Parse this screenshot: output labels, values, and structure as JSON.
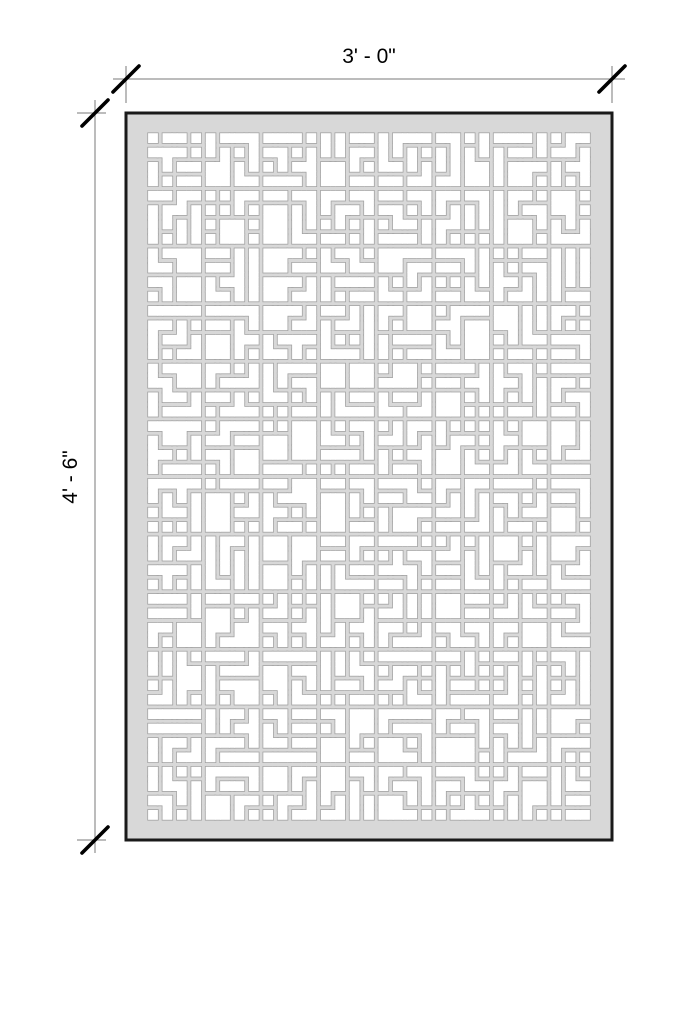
{
  "drawing": {
    "title": "decorative panel shop drawing",
    "width_label": "3' - 0\"",
    "height_label": "4' - 6\""
  },
  "panel": {
    "x": 126,
    "y": 113,
    "width": 486,
    "height": 727,
    "fill": "#d8d8d8",
    "border_color": "#1a1a1a",
    "border_width": 3
  },
  "pattern": {
    "seed": 12,
    "cols": 31,
    "rows": 48,
    "pitch": 14.4,
    "gap": 4.6,
    "block": 4,
    "cutout_fill": "#ffffff",
    "outline_color": "#a3a3a3",
    "outline_width": 1.6,
    "group_sizes": [
      1,
      1,
      2,
      2,
      2,
      3,
      3,
      3,
      3,
      4,
      4,
      4,
      4,
      5,
      5,
      6
    ]
  },
  "dimensions": {
    "line_color": "#7a7a7a",
    "line_width": 1,
    "tick_color": "#000000",
    "tick_width": 3.6,
    "tick_half": 13,
    "top": {
      "label": "3' - 0\"",
      "y": 79,
      "x1": 126,
      "x2": 612,
      "overshoot": 13,
      "ext_a": 66,
      "ext_b": 103
    },
    "left": {
      "label": "4' - 6\"",
      "x": 95,
      "y1": 113,
      "y2": 840,
      "overshoot": 13,
      "ext_a": 77,
      "ext_b": 106
    }
  }
}
